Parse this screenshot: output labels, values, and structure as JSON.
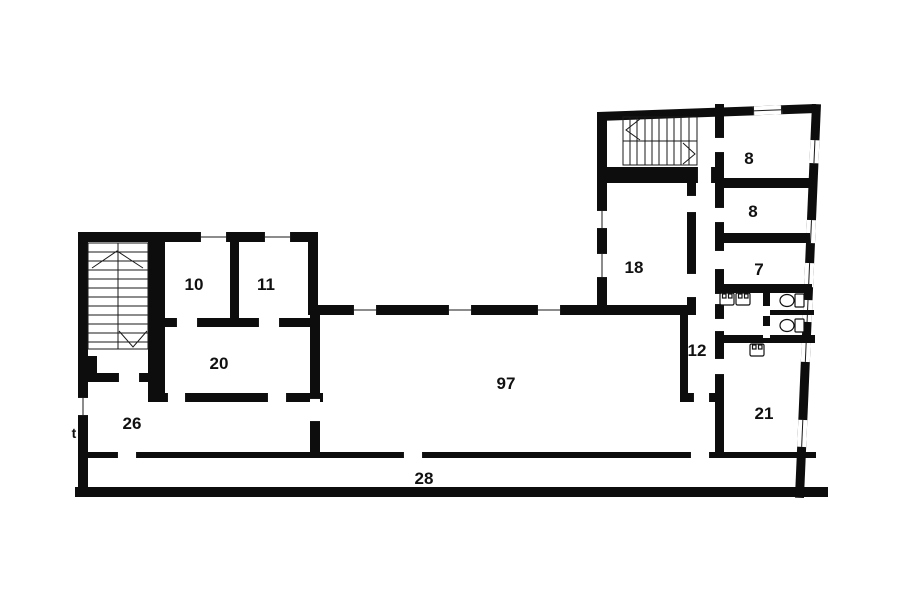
{
  "plan": {
    "type": "architectural-floor-plan",
    "background_color": "#ffffff",
    "wall_color": "#0d0d0d",
    "detail_line_color": "#1a1a1a",
    "rooms": {
      "r10": {
        "label": "10"
      },
      "r11": {
        "label": "11"
      },
      "r20": {
        "label": "20"
      },
      "r26": {
        "label": "26"
      },
      "r97": {
        "label": "97"
      },
      "r28": {
        "label": "28"
      },
      "r18": {
        "label": "18"
      },
      "r12": {
        "label": "12"
      },
      "r8a": {
        "label": "8"
      },
      "r8b": {
        "label": "8"
      },
      "r7": {
        "label": "7"
      },
      "r21": {
        "label": "21"
      }
    },
    "entrance_marker": {
      "label": "t"
    },
    "staircases": [
      {
        "id": "left-staircase",
        "flights": 2
      },
      {
        "id": "right-staircase",
        "flights": 2
      }
    ],
    "fixtures": {
      "sinks": 3,
      "toilets": 2
    }
  }
}
